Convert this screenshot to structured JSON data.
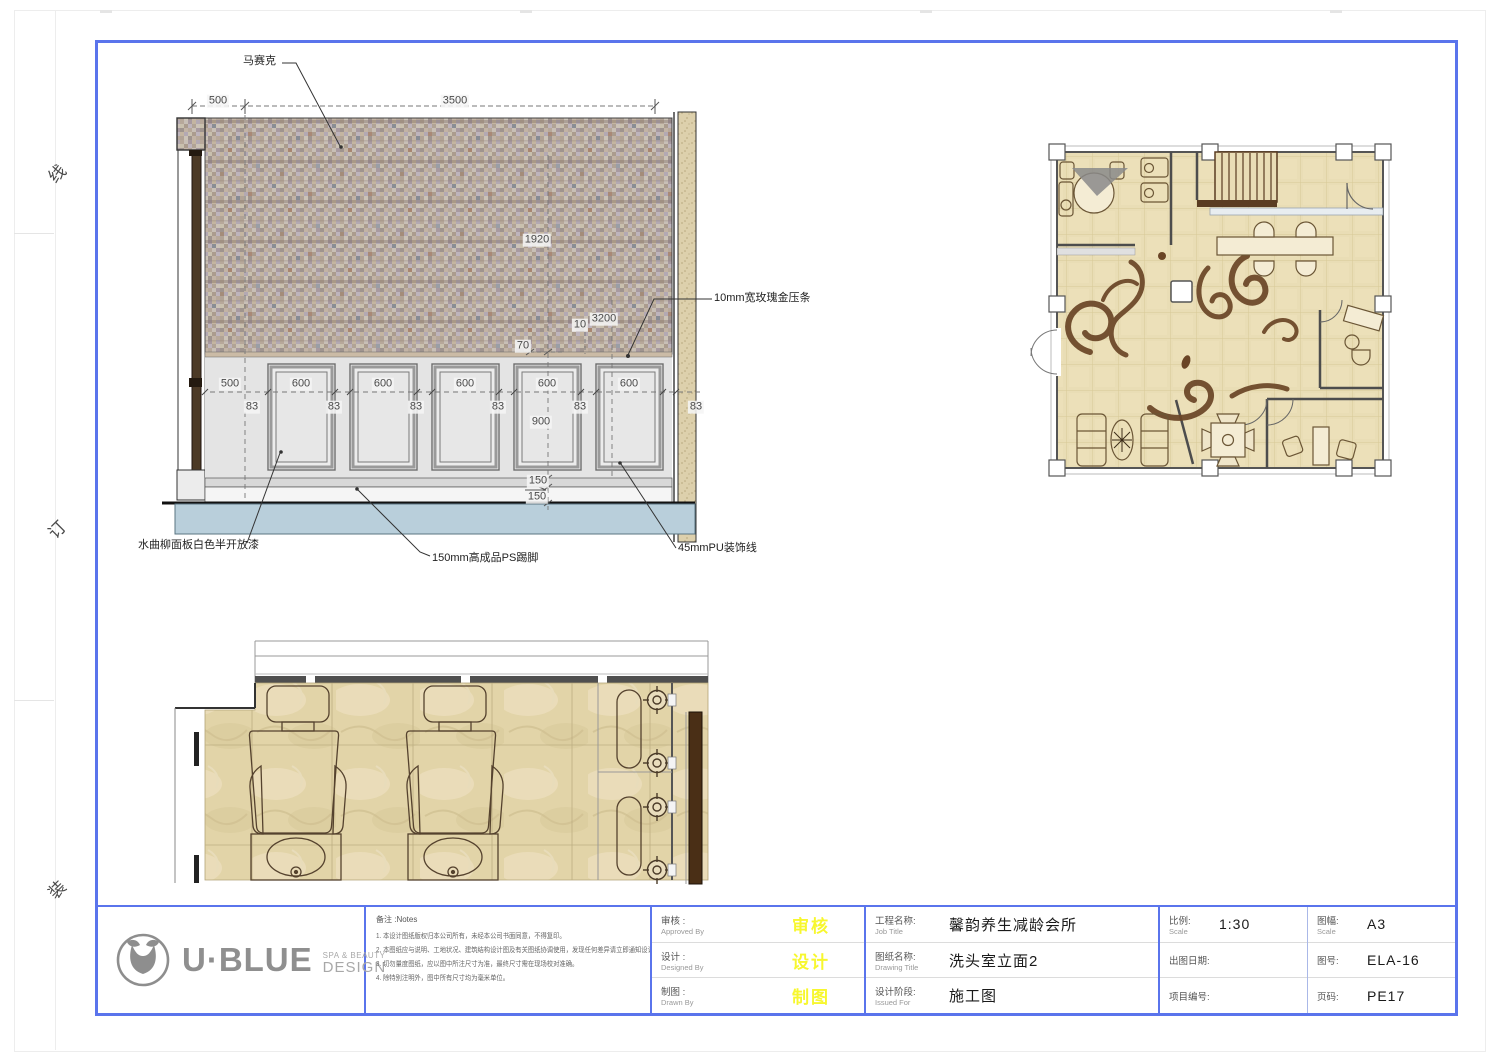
{
  "sheet": {
    "binding_marks": [
      "线",
      "订",
      "装"
    ]
  },
  "elevation": {
    "callouts": {
      "mosaic": "马赛克",
      "rose_gold_strip": "10mm宽玫瑰金压条",
      "ash_panel": "水曲柳面板白色半开放漆",
      "skirting": "150mm高成品PS踢脚",
      "pu_moulding": "45mmPU装饰线"
    },
    "dims": {
      "top": [
        "500",
        "3500"
      ],
      "heights": [
        "1920",
        "3200",
        "10",
        "70",
        "900"
      ],
      "panel_lead": "500",
      "panel_width": "600",
      "gap": "83",
      "skirt": [
        "150",
        "150"
      ]
    }
  },
  "titleblock": {
    "logo": {
      "name": "U·BLUE",
      "tagline_top": "SPA & BEAUTY",
      "tagline_bottom": "DESIGN"
    },
    "notes": {
      "title": "备注 :Notes",
      "items": [
        "1. 本设计图纸版权归本公司所有，未经本公司书面同意，不得复印。",
        "2. 本图纸应与说明、工地状况、建筑结构设计图及有关图纸协调使用，发现任何差异请立即通知设计师。",
        "3. 切勿量度图纸，应以图中所注尺寸为准，最终尺寸需在现场校对准确。",
        "4. 除特别注明外，图中所有尺寸均为毫米单位。"
      ]
    },
    "signoff": [
      {
        "label": "审核 :",
        "sub": "Approved By",
        "stamp": "审核"
      },
      {
        "label": "设计 :",
        "sub": "Designed By",
        "stamp": "设计"
      },
      {
        "label": "制图 :",
        "sub": "Drawn By",
        "stamp": "制图"
      }
    ],
    "project": [
      {
        "label": "工程名称:",
        "sub": "Job Title",
        "value": "馨韵养生减龄会所"
      },
      {
        "label": "图纸名称:",
        "sub": "Drawing Title",
        "value": "洗头室立面2"
      },
      {
        "label": "设计阶段:",
        "sub": "Issued For",
        "value": "施工图"
      }
    ],
    "meta_left": [
      {
        "label": "比例:",
        "sub": "Scale",
        "value": "1:30"
      },
      {
        "label": "出图日期:",
        "sub": "",
        "value": ""
      },
      {
        "label": "项目编号:",
        "sub": "",
        "value": ""
      }
    ],
    "meta_right": [
      {
        "label": "图幅:",
        "sub": "Scale",
        "value": "A3"
      },
      {
        "label": "图号:",
        "sub": "",
        "value": "ELA-16"
      },
      {
        "label": "页码:",
        "sub": "",
        "value": "PE17"
      }
    ],
    "colors": {
      "frame_blue": "#5a74ec",
      "stamp_yellow": "#f7f72e",
      "floor_blue": "#b9cfdb"
    }
  }
}
